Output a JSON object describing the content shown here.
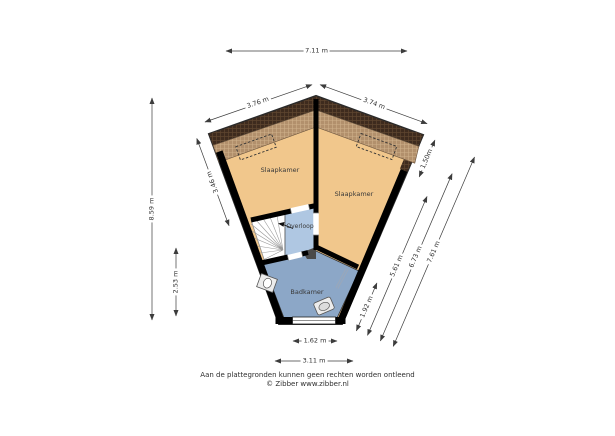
{
  "floorplan": {
    "rooms": [
      {
        "label": "Slaapkamer"
      },
      {
        "label": "Slaapkamer"
      },
      {
        "label": "Overloop"
      },
      {
        "label": "Badkamer"
      }
    ],
    "dimensions": {
      "overall_width": "7.11 m",
      "roof_edge_left": "3.76 m",
      "roof_edge_right": "3.74 m",
      "overall_height": "8.59 m",
      "left_wall": "3.46 m",
      "left_lower": "2.53 m",
      "right_roof": "1,50m",
      "right_inner": "5.61 m",
      "right_middle": "6.73 m",
      "right_outer": "7.61 m",
      "right_lower": "1.92 m",
      "bottom_window": "1.62 m",
      "bottom_width": "3.11 m"
    },
    "fixtures": [
      {
        "name": "stairs"
      },
      {
        "name": "stairs-direction-arrow"
      },
      {
        "name": "toilet"
      },
      {
        "name": "sink"
      },
      {
        "name": "radiator"
      },
      {
        "name": "window"
      },
      {
        "name": "skylight-left"
      },
      {
        "name": "skylight-right"
      }
    ],
    "colors": {
      "floor": "#F1C78C",
      "roof_dark": "#3E2B1E",
      "roof_dark_grid": "#5E452F",
      "roof_light": "#B2906C",
      "roof_light_grid": "#CFB08A",
      "landing": "#AFC7E2",
      "bathroom": "#8CA7C7",
      "wall": "#000000",
      "dimension": "#3C3C3C"
    },
    "footer": {
      "line1": "Aan de plattegronden kunnen geen rechten worden ontleend",
      "line2": "© Zibber www.zibber.nl"
    }
  }
}
